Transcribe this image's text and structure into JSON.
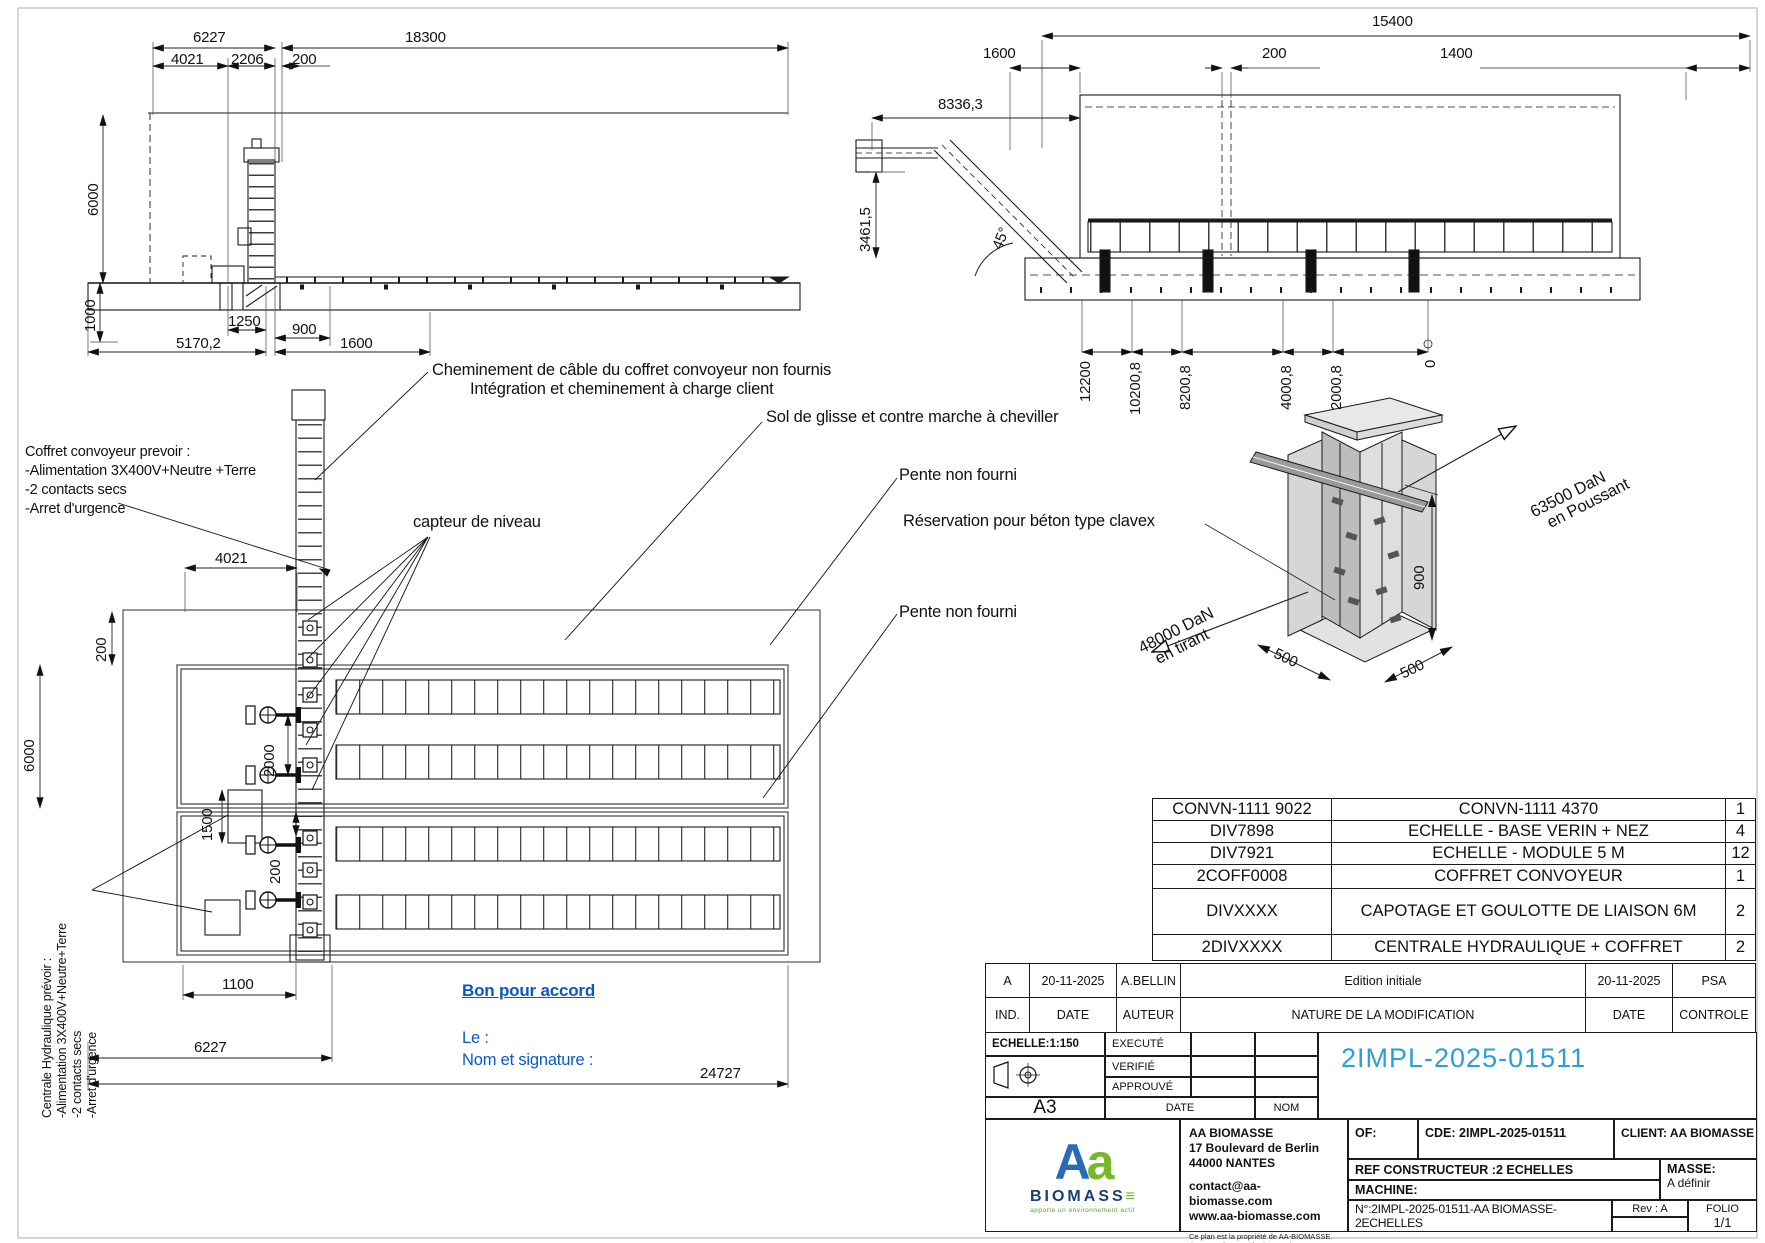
{
  "colors": {
    "line": "#1a1a1a",
    "doc_number_blue": "#2b9fd8",
    "approval_blue": "#0a58c8",
    "logo_blue": "#2a6cb4",
    "logo_green": "#76b82a",
    "logo_navy": "#1b3f72"
  },
  "elev_left": {
    "d6227": "6227",
    "d18300": "18300",
    "d4021": "4021",
    "d2206": "2206",
    "d200": "200",
    "d6000": "6000",
    "d1000": "1000",
    "d1250": "1250",
    "d5170": "5170,2",
    "d900": "900",
    "d1600": "1600"
  },
  "elev_right": {
    "d15400": "15400",
    "d1600": "1600",
    "d200": "200",
    "d1400": "1400",
    "d8336": "8336,3",
    "d3461": "3461,5",
    "angle": "45°",
    "chainage": [
      "12200",
      "10200,8",
      "8200,8",
      "4000,8",
      "2000,8",
      "0"
    ]
  },
  "plan": {
    "note_cable1": "Cheminement de câble du coffret convoyeur non fournis",
    "note_cable2": "Intégration et cheminement à charge client",
    "note_sol": "Sol de glisse et contre marche à cheviller",
    "note_pente1": "Pente non fourni",
    "note_reservation": "Réservation pour béton type clavex",
    "note_pente2": "Pente non fourni",
    "note_capteur": "capteur de niveau",
    "coffret_note": [
      "Coffret convoyeur prevoir :",
      "-Alimentation 3X400V+Neutre +Terre",
      "-2 contacts secs",
      "-Arret d'urgence"
    ],
    "centrale_note": [
      "Centrale Hydraulique prévoir :",
      "-Alimentation 3X400V+Neutre+Terre",
      "-2 contacts secs",
      "-Arret d'urgence"
    ],
    "d4021": "4021",
    "d200a": "200",
    "d6000": "6000",
    "d2000": "2000",
    "d1500": "1500",
    "d200b": "200",
    "d1100": "1100",
    "d6227": "6227",
    "d24727": "24727"
  },
  "approval": {
    "title": "Bon pour accord",
    "line1": "Le :",
    "line2": "Nom et signature :"
  },
  "iso": {
    "push1": "63500 DaN",
    "push2": "en Poussant",
    "pull1": "48000 DaN",
    "pull2": "en tirant",
    "d900": "900",
    "d500a": "500",
    "d500b": "500"
  },
  "bom": {
    "rows": [
      {
        "ref": "CONVN-1111 9022",
        "desc": "CONVN-1111 4370",
        "qty": "1"
      },
      {
        "ref": "DIV7898",
        "desc": "ECHELLE - BASE VERIN + NEZ",
        "qty": "4"
      },
      {
        "ref": "DIV7921",
        "desc": "ECHELLE - MODULE 5 M",
        "qty": "12"
      },
      {
        "ref": "2COFF0008",
        "desc": "COFFRET CONVOYEUR",
        "qty": "1"
      },
      {
        "ref": "DIVXXXX",
        "desc": "CAPOTAGE ET GOULOTTE DE LIAISON 6M",
        "qty": "2"
      },
      {
        "ref": "2DIVXXXX",
        "desc": "CENTRALE HYDRAULIQUE + COFFRET",
        "qty": "2"
      }
    ]
  },
  "revisions": {
    "entry": {
      "ind": "A",
      "date": "20-11-2025",
      "author": "A.BELLIN",
      "nature": "Edition initiale",
      "date2": "20-11-2025",
      "control": "PSA"
    },
    "headers": {
      "ind": "IND.",
      "date": "DATE",
      "author": "AUTEUR",
      "nature": "NATURE DE LA MODIFICATION",
      "date2": "DATE",
      "control": "CONTROLE"
    }
  },
  "titleblock": {
    "scale": "ECHELLE:1:150",
    "executed": "EXECUTÉ",
    "verified": "VERIFIÉ",
    "approved": "APPROUVÉ",
    "format": "A3",
    "date_label": "DATE",
    "name_label": "NOM",
    "doc_number": "2IMPL-2025-01511",
    "company": {
      "name": "AA BIOMASSE",
      "address1": "17 Boulevard de Berlin",
      "address2": "44000 NANTES",
      "email": "contact@aa-biomasse.com",
      "web": "www.aa-biomasse.com",
      "legal1": "Ce plan est la propriété de AA-BIOMASSE.",
      "legal2": "Il ne peut être copié, ni transmis  sans son autorisation."
    },
    "logo": {
      "aa1": "A",
      "aa2": "a",
      "biomasse": "BIOMASS",
      "eq": "≡",
      "tagline": "apporte un environnement actif"
    },
    "of_label": "OF:",
    "cde": "CDE: 2IMPL-2025-01511",
    "client": "CLIENT: AA BIOMASSE",
    "ref_constructeur": "REF CONSTRUCTEUR :2 ECHELLES",
    "masse_label": "MASSE:",
    "masse_value": "A définir",
    "machine_label": "MACHINE:",
    "num": "N°:2IMPL-2025-01511-AA BIOMASSE-2ECHELLES",
    "rev": "Rev : A",
    "folio_label": "FOLIO",
    "folio_value": "1/1"
  }
}
